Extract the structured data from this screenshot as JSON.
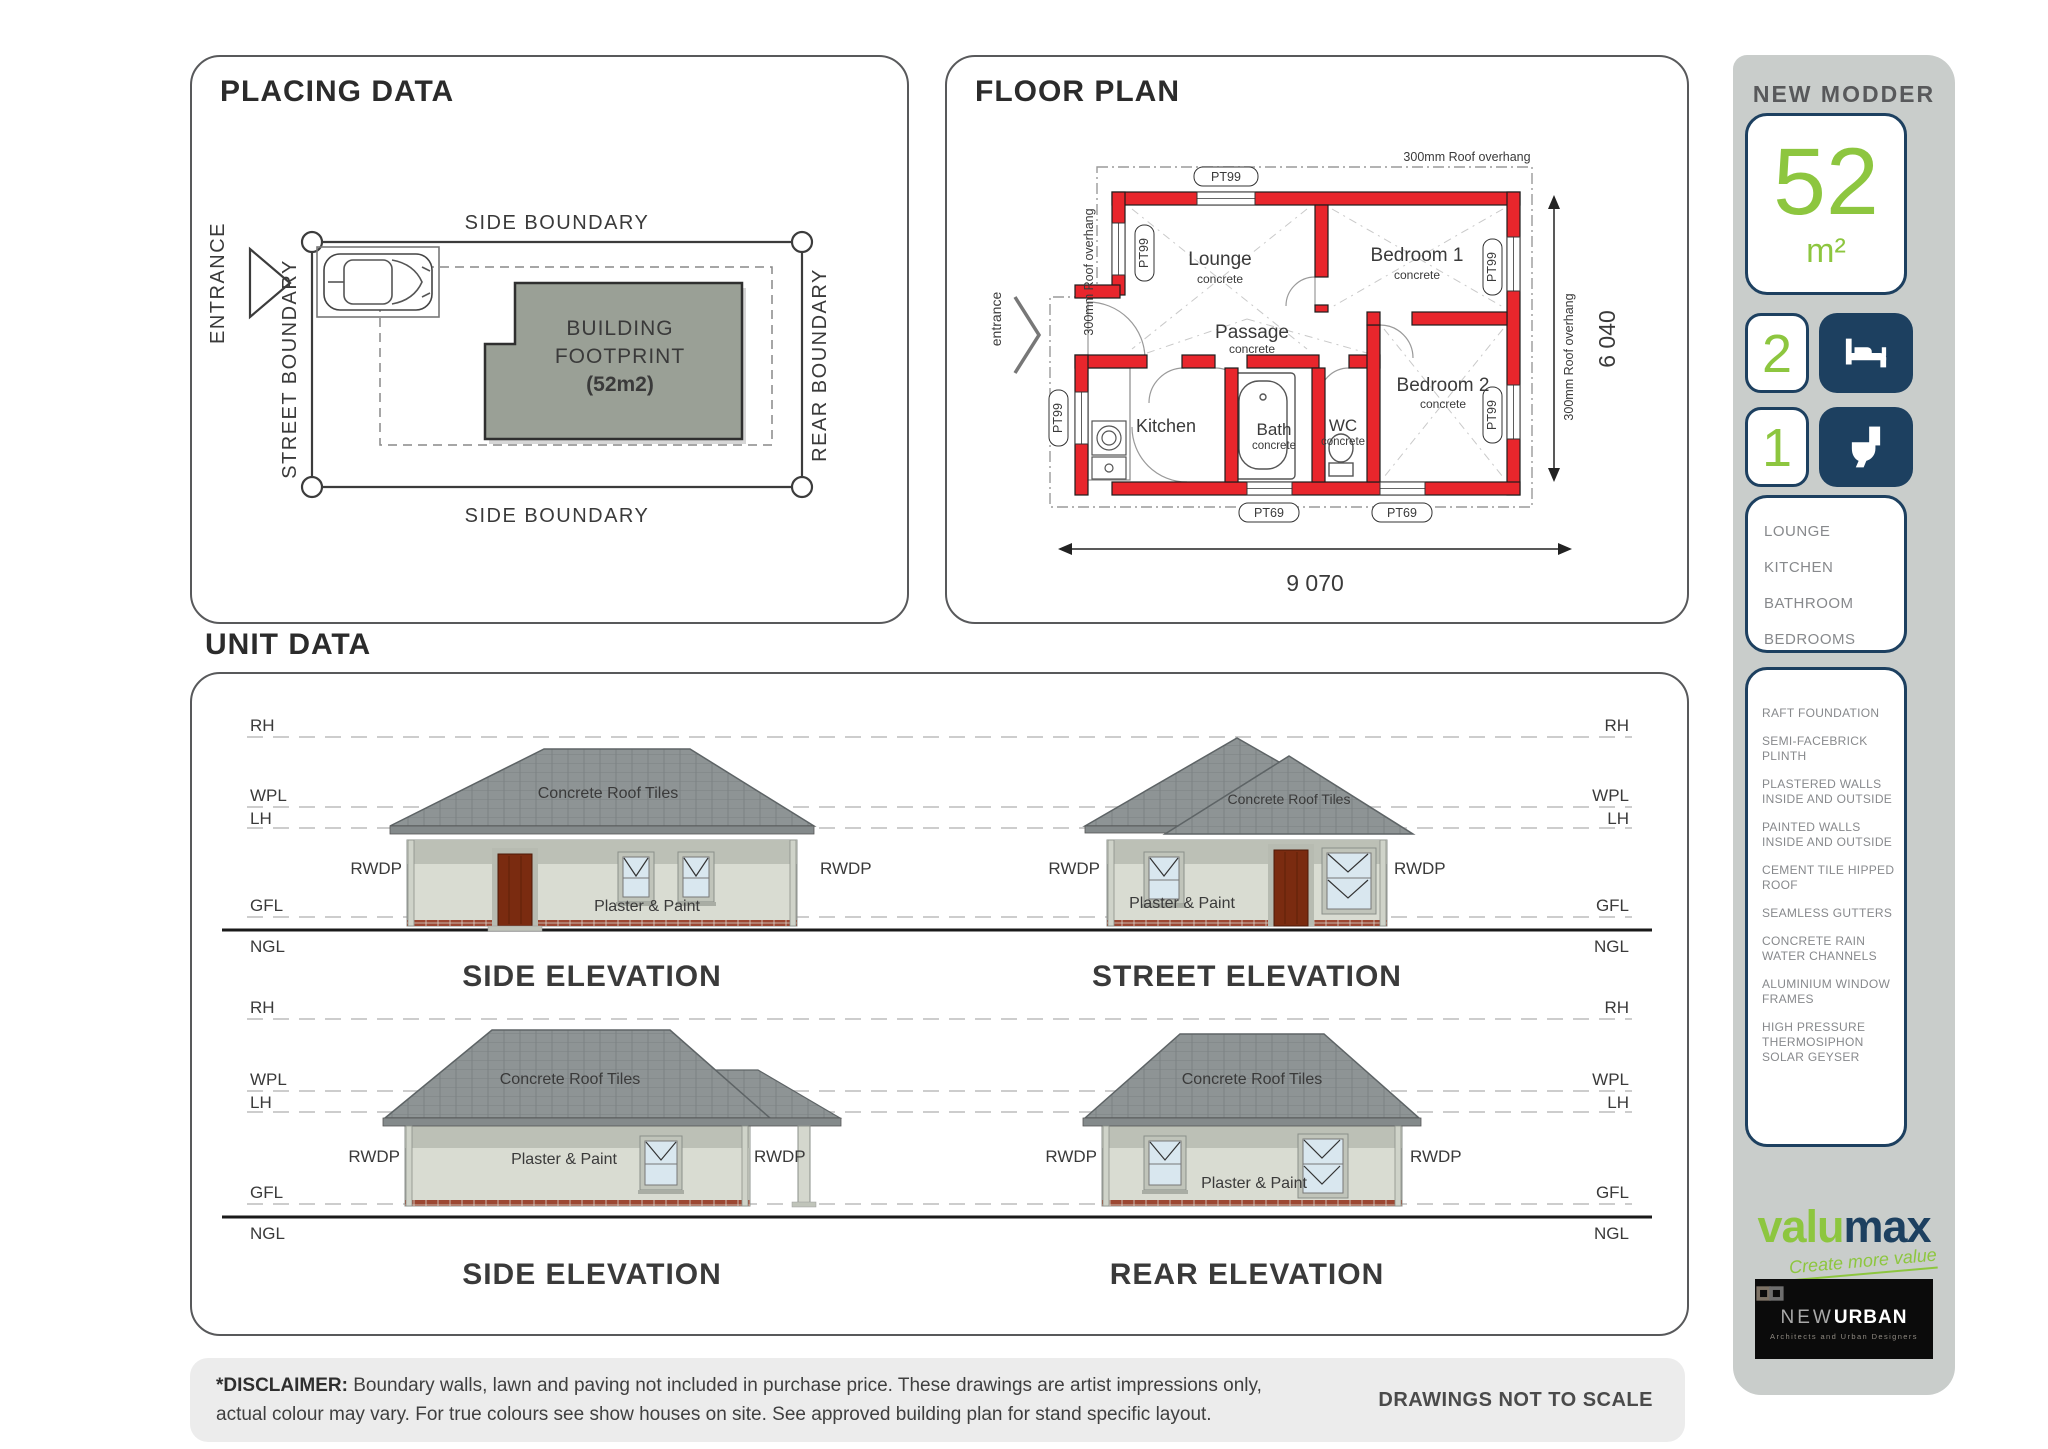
{
  "placing": {
    "title": "PLACING DATA",
    "entrance_label": "ENTRANCE",
    "street_boundary": "STREET BOUNDARY",
    "side_boundary": "SIDE BOUNDARY",
    "rear_boundary": "REAR BOUNDARY",
    "footprint": {
      "line1": "BUILDING",
      "line2": "FOOTPRINT",
      "line3": "(52m2)"
    }
  },
  "floor_plan": {
    "title": "FLOOR PLAN",
    "entrance_label": "entrance",
    "roof_overhang": "300mm Roof overhang",
    "window_type_main": "PT99",
    "window_type_small": "PT69",
    "rooms": {
      "lounge": {
        "name": "Lounge",
        "finish": "concrete"
      },
      "bedroom1": {
        "name": "Bedroom 1",
        "finish": "concrete"
      },
      "bedroom2": {
        "name": "Bedroom 2",
        "finish": "concrete"
      },
      "passage": {
        "name": "Passage",
        "finish": "concrete"
      },
      "kitchen": {
        "name": "Kitchen"
      },
      "bath": {
        "name": "Bath",
        "finish": "concrete"
      },
      "wc": {
        "name": "WC",
        "finish": "concrete"
      }
    },
    "dimensions": {
      "width": "9 070",
      "depth": "6 040"
    }
  },
  "sidebar": {
    "model_name": "NEW MODDER X8",
    "area": {
      "value": "52",
      "unit": "m²"
    },
    "bedrooms": "2",
    "bathrooms": "1",
    "rooms": [
      "LOUNGE",
      "KITCHEN",
      "BATHROOM",
      "BEDROOMS"
    ],
    "features": [
      "RAFT FOUNDATION",
      "SEMI-FACEBRICK PLINTH",
      "PLASTERED WALLS INSIDE AND OUTSIDE",
      "PAINTED WALLS INSIDE AND OUTSIDE",
      "CEMENT TILE HIPPED ROOF",
      "SEAMLESS GUTTERS",
      "CONCRETE RAIN WATER CHANNELS",
      "ALUMINIUM WINDOW FRAMES",
      "HIGH PRESSURE THERMOSIPHON SOLAR GEYSER"
    ],
    "valumax": {
      "word1": "valu",
      "word2": "max",
      "tagline": "Create more value"
    },
    "newurban": {
      "word1": "NEW",
      "word2": "URBAN",
      "tagline": "Architects and Urban Designers"
    }
  },
  "unit_data": {
    "title": "UNIT DATA",
    "levels": {
      "rh": "RH",
      "wpl": "WPL",
      "lh": "LH",
      "gfl": "GFL",
      "ngl": "NGL"
    },
    "rwdp": "RWDP",
    "roof_label": "Concrete Roof Tiles",
    "wall_label": "Plaster & Paint",
    "elevation_titles": {
      "side1": "SIDE ELEVATION",
      "street": "STREET ELEVATION",
      "side2": "SIDE ELEVATION",
      "rear": "REAR ELEVATION"
    }
  },
  "footer": {
    "disclaimer_label": "*DISCLAIMER:",
    "disclaimer_line1": "Boundary walls, lawn and paving not included in purchase price. These drawings are artist impressions only,",
    "disclaimer_line2": "actual colour may vary. For true colours see show houses on site. See approved building plan for stand specific layout.",
    "scale_note": "DRAWINGS NOT TO SCALE"
  },
  "colors": {
    "accent_green": "#8dc63f",
    "navy": "#1d4060",
    "wall_red": "#e8262c",
    "sidebar_bg": "#c9cdcb"
  }
}
